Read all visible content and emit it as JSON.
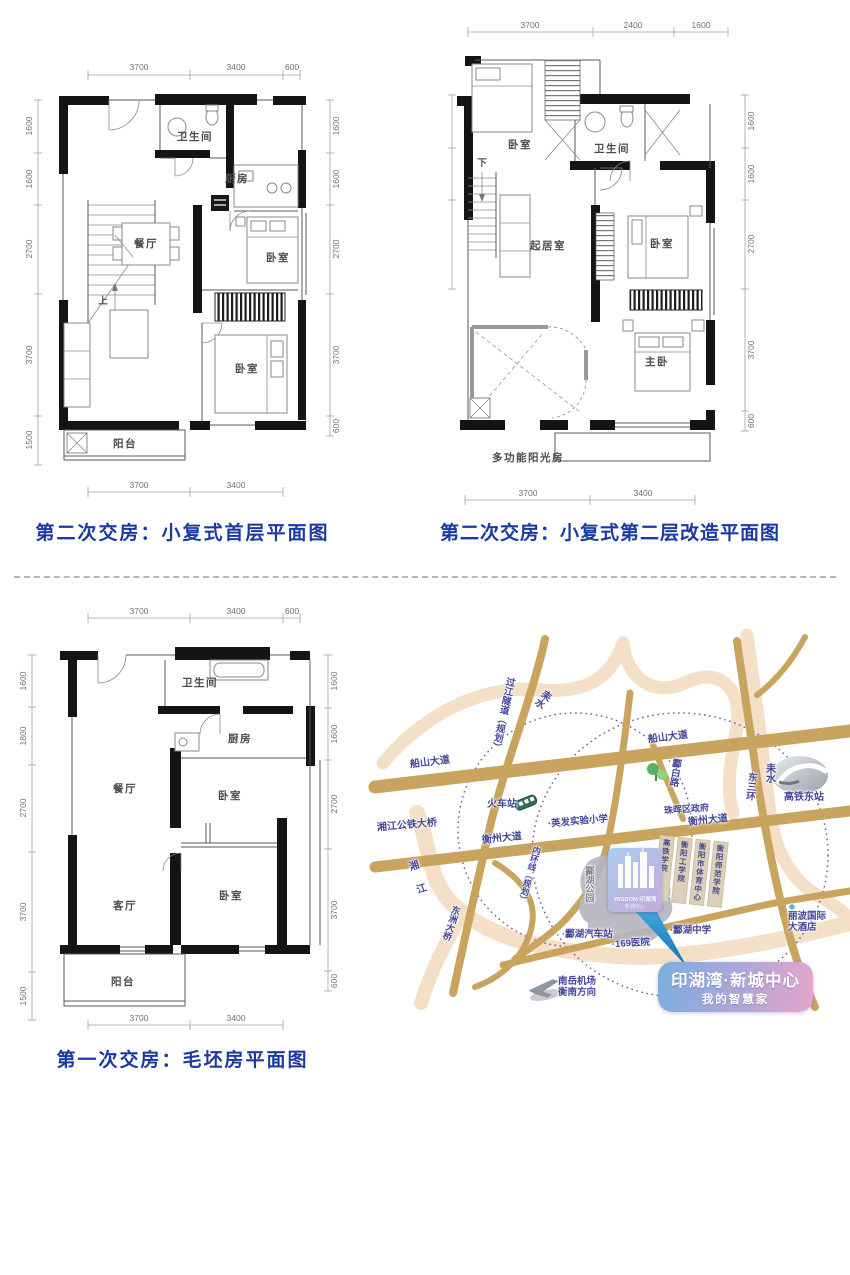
{
  "captions": {
    "plan_a": "第二次交房：小复式首层平面图",
    "plan_b": "第二次交房：小复式第二层改造平面图",
    "plan_c": "第一次交房：毛坯房平面图"
  },
  "plan_a": {
    "dims_top": [
      "3700",
      "3400",
      "600"
    ],
    "dims_bottom": [
      "3700",
      "3400"
    ],
    "dims_left": [
      "1600",
      "1600",
      "2700",
      "3700",
      "1500"
    ],
    "dims_right": [
      "1600",
      "1600",
      "2700",
      "3700",
      "600"
    ],
    "rooms": {
      "bath": "卫生间",
      "kitchen": "厨房",
      "dining": "餐厅",
      "bed1": "卧室",
      "bed2": "卧室",
      "balcony": "阳台",
      "stair_up": "上"
    }
  },
  "plan_b": {
    "dims_top": [
      "3700",
      "2400",
      "1600"
    ],
    "dims_bottom": [
      "3700",
      "3400"
    ],
    "dims_right": [
      "1600",
      "1600",
      "2700",
      "3700",
      "600"
    ],
    "rooms": {
      "bed1": "卧室",
      "bath": "卫生间",
      "living": "起居室",
      "bed2": "卧室",
      "master": "主卧",
      "sunroom": "多功能阳光房",
      "stair_down": "下"
    }
  },
  "plan_c": {
    "dims_top": [
      "3700",
      "3400",
      "600"
    ],
    "dims_bottom": [
      "3700",
      "3400"
    ],
    "dims_left": [
      "1600",
      "1800",
      "2700",
      "3700",
      "1500"
    ],
    "dims_right": [
      "1600",
      "1600",
      "2700",
      "3700",
      "600"
    ],
    "rooms": {
      "bath": "卫生间",
      "kitchen": "厨房",
      "dining": "餐厅",
      "bed1": "卧室",
      "living": "客厅",
      "bed2": "卧室",
      "balcony": "阳台"
    }
  },
  "map": {
    "road_labels": {
      "chuanshan_w": "船山大道",
      "chuanshan_e": "船山大道",
      "hengzhou_w": "衡州大道",
      "hengzhou_e": "衡州大道",
      "tunnel": "过江隧道（规划）",
      "neihuan": "内环线（规划）",
      "lingbai": "酃白路",
      "dongsanhuan": "东三环",
      "dongzhou_bridge": "东洲大桥"
    },
    "river_labels": {
      "leishui_n": "耒水",
      "leishui_e": "耒水",
      "xiangjiang": "湘江"
    },
    "place_labels": {
      "train_station": "火车站",
      "yingfa_school": "·英发实验小学",
      "xiangjiang_bridge": "湘江公铁大桥",
      "zhuhui_gov": "珠晖区政府",
      "gaotie_east": "高铁东站",
      "linghu_park": "酃湖公园",
      "linghu_bus": "·酃湖汽车站",
      "hospital_169": "·169医院",
      "linghu_school": "·酃湖中学",
      "libo_hotel_line1": "丽波国际",
      "libo_hotel_line2": "大酒店",
      "airport_line1": "南岳机场",
      "airport_line2": "衡南方向"
    },
    "colleges": [
      "高铁学院",
      "衡阳工学院",
      "衡阳市体育中心",
      "衡阳师范学院"
    ],
    "marker": {
      "title": "WISDOM 印湖湾",
      "sub": "新城中心"
    },
    "callout": {
      "line1": "印湖湾·新城中心",
      "line2": "我的智慧家"
    },
    "colors": {
      "road": "#c9a45e",
      "river": "#f4e0c6",
      "label": "#45459b",
      "accent_blue": "#79b0e0",
      "accent_pink": "#e7a6c9"
    }
  }
}
